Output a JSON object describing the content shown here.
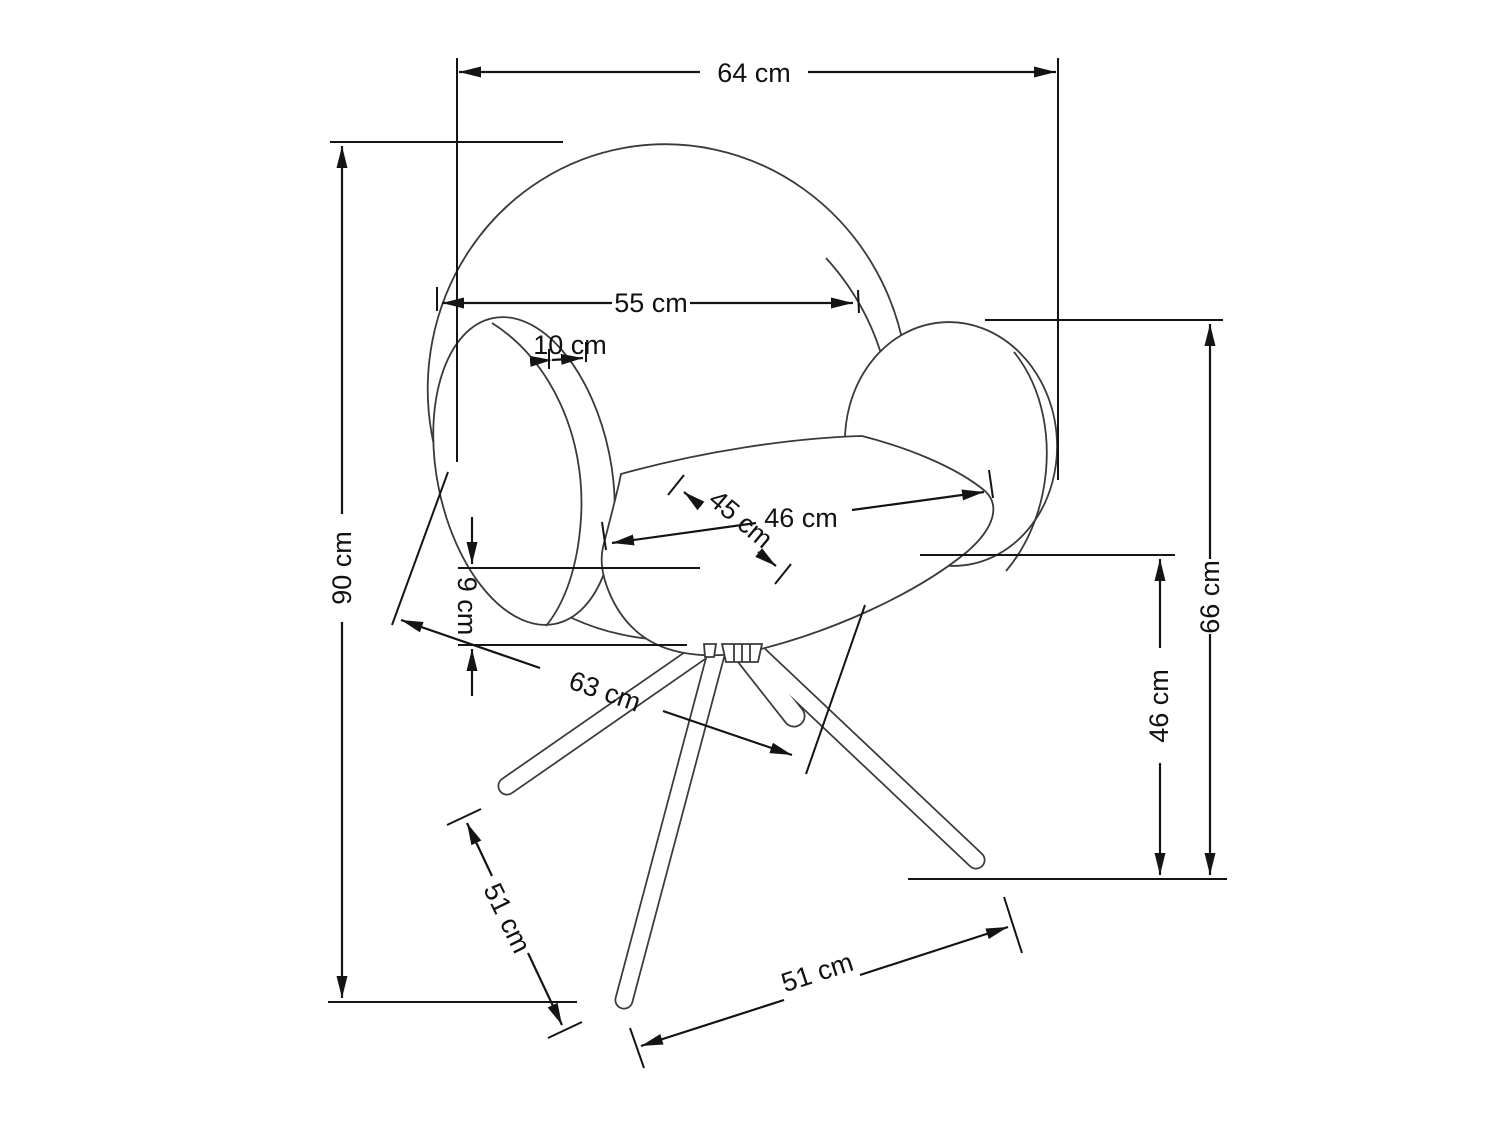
{
  "diagram": {
    "subject": "swivel-armchair-technical-dimension-drawing",
    "unit": "cm",
    "dims": {
      "overall_width": {
        "label": "64 cm",
        "value": 64
      },
      "backrest_width": {
        "label": "55 cm",
        "value": 55
      },
      "armrest_thickness": {
        "label": "10 cm",
        "value": 10
      },
      "overall_height": {
        "label": "90 cm",
        "value": 90
      },
      "cushion_thickness": {
        "label": "9 cm",
        "value": 9
      },
      "seat_depth": {
        "label": "45 cm",
        "value": 45
      },
      "seat_width": {
        "label": "46 cm",
        "value": 46
      },
      "base_depth": {
        "label": "63 cm",
        "value": 63
      },
      "armrest_height": {
        "label": "66 cm",
        "value": 66
      },
      "seat_height": {
        "label": "46 cm",
        "value": 46
      },
      "leg_length": {
        "label": "51 cm",
        "value": 51
      },
      "base_width": {
        "label": "51 cm",
        "value": 51
      }
    }
  }
}
